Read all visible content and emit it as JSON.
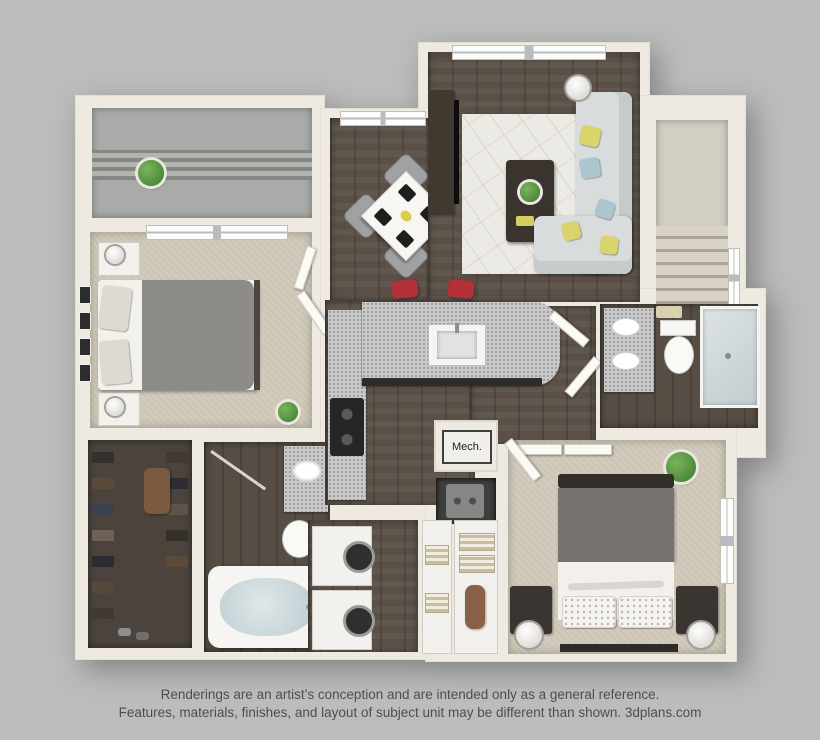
{
  "caption": {
    "line1": "Renderings are an artist’s conception and are intended only as a general reference.",
    "line2": "Features, materials, finishes, and layout of subject unit may be different than shown. 3dplans.com"
  },
  "labels": {
    "mech": "Mech."
  },
  "palette": {
    "background": "#bcbcbc",
    "wall": "#eeeae1",
    "wood_floor": "#5a5047",
    "carpet": "#d2cbbc",
    "dark_tile": "#564d45",
    "granite_counter": "#c9c9c9",
    "bar_stool_red": "#b43038",
    "pillow_yellow": "#d9d46b",
    "pillow_blue": "#abc6cf",
    "plant_green": "#4f8b3b",
    "caption_text": "#4e4e4e"
  }
}
